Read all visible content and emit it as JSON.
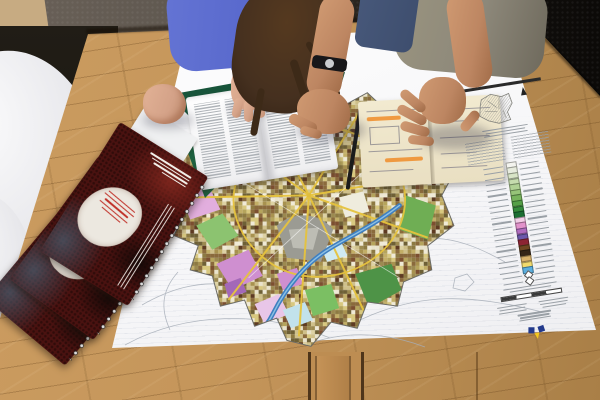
{
  "scene": {
    "description": "Top-down photo: two urban planners lean over a large printed city land-use map on an oak table; open brochure booklet, sketch notebook, spiral-bound red report covers, white shell chairs at left",
    "objects": [
      "city-map-poster",
      "map-legend",
      "open-booklet",
      "sketch-notebook",
      "spiral-brochures",
      "wood-table",
      "white-chairs",
      "woman-blue-sweater",
      "man-grey-tshirt",
      "wrist-watch",
      "notebook-elastic-band"
    ]
  },
  "colors": {
    "floor": "#14110e",
    "carpet": "#5d564e",
    "mat": "#c7ab82",
    "wood": "#cb9c60",
    "wood-dark": "#a97f47",
    "poster": "#f6f6f8",
    "stripe": "#b9c2cf",
    "contour": "#a7aeb8",
    "booklet-page": "#eeeef0",
    "text-grey": "#9aa0a6",
    "notebook-page": "#e9dfc2",
    "notebook-line": "#5c5c74",
    "highlight-orange": "#f08c28",
    "elastic": "#1b1b1b",
    "legend-bar": "#2a2a2a",
    "inset-grey": "#cfcfca",
    "brochure-cover": "#4a1210",
    "brochure-text": "#f2efe9",
    "brochure-red-text": "#c03028",
    "spiral": "#dcdcdc",
    "sweater": "#5767cb",
    "tee": "#8d887a",
    "jeans": "#3e4e6e",
    "skin-man": "#bd8662",
    "skin-woman": "#d4a288",
    "hair": "#45301f",
    "watch": "#17171a",
    "watch-face": "#c9ccd0",
    "river": "#3f7fc0",
    "river-light": "#8cc0e4",
    "road": "#e6c33e",
    "map-edge": "#6b6b66",
    "wedge-green": "#17543a",
    "z-green-dark": "#3f7d3c",
    "z-green": "#6fae54",
    "z-green-mid": "#4e9347",
    "z-green-light": "#7bbf63",
    "z-green-pale": "#8cc370",
    "z-pink": "#e2aede",
    "z-pink-deep": "#cf8fd0",
    "z-pink-pale": "#e8c6e8",
    "z-lilac": "#f2d8f0",
    "z-purple": "#a368b8",
    "z-blue-pale": "#c2e2ec",
    "z-blue-ice": "#cfeaf2",
    "z-grey": "#9b9b93",
    "z-grey-light": "#bdbdb4",
    "z-cream": "#efecdd",
    "logo-navy": "#233a8c",
    "logo-yellow": "#f3c81e"
  },
  "map": {
    "mosaic": [
      "#d8c87f",
      "#c2ae66",
      "#a8924f",
      "#8d7a42",
      "#e9e3cc",
      "#cfc08a",
      "#b5a45c",
      "#6e6036",
      "#f0ead6",
      "#9c8a50",
      "#7c4f30",
      "#5e3b22",
      "#8a6a3c",
      "#ddd2a4"
    ]
  },
  "legend": {
    "swatches": [
      "#f4f4ef",
      "#e7ebdd",
      "#d8e4c6",
      "#c6dcae",
      "#b0d194",
      "#96c478",
      "#77b35c",
      "#55a047",
      "#358a3b",
      "#1c6f33",
      "#f2cde6",
      "#e292cb",
      "#b06cbf",
      "#6b58ab",
      "#8c2433",
      "#6e4722",
      "#352517",
      "#d9b26b",
      "#f1da6d",
      "#5aaede"
    ],
    "symbols": [
      "diamond",
      "diamond"
    ]
  }
}
